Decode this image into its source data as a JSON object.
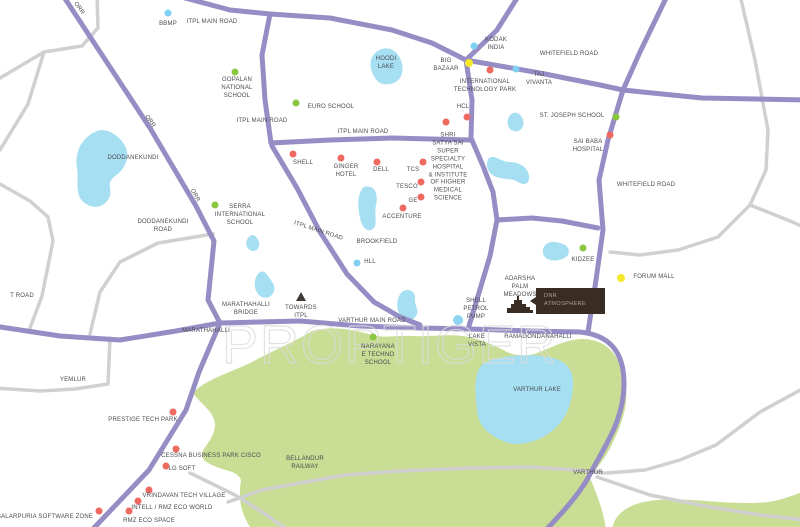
{
  "watermark": {
    "text": "PROPTIGER"
  },
  "project": {
    "name_line1": "DNR",
    "name_line2": "ATMOSPHERE"
  },
  "colors": {
    "road_major": "#968dc5",
    "road_minor": "#d0d0d0",
    "water": "#a6def2",
    "green_area": "#c9dd95",
    "project_box": "#382c23",
    "red": "#ee6a60",
    "green": "#8cc63e",
    "blue": "#7fd0f2",
    "yellow": "#f5e829",
    "lightblue": "#8ed4f0"
  },
  "map": {
    "dots": [
      {
        "name": "dot-bbmp",
        "type": "blue",
        "x": 168,
        "y": 13
      },
      {
        "name": "dot-kodak-india",
        "type": "blue",
        "x": 474,
        "y": 46
      },
      {
        "name": "dot-taj-vivanta",
        "type": "blue",
        "x": 516,
        "y": 69
      },
      {
        "name": "dot-hll",
        "type": "blue",
        "x": 357,
        "y": 263
      },
      {
        "name": "dot-big-bazaar",
        "type": "yellow",
        "x": 469,
        "y": 63
      },
      {
        "name": "dot-forum-mall",
        "type": "yellow",
        "x": 621,
        "y": 278
      },
      {
        "name": "dot-international-technology-park",
        "type": "red",
        "x": 490,
        "y": 70
      },
      {
        "name": "dot-hcl",
        "type": "red",
        "x": 467,
        "y": 117
      },
      {
        "name": "dot-satya-sai-hospital",
        "type": "red",
        "x": 446,
        "y": 122
      },
      {
        "name": "dot-sai-baba-hospital",
        "type": "red",
        "x": 610,
        "y": 135
      },
      {
        "name": "dot-shell",
        "type": "red",
        "x": 293,
        "y": 154
      },
      {
        "name": "dot-ginger-hotel",
        "type": "red",
        "x": 341,
        "y": 158
      },
      {
        "name": "dot-dell",
        "type": "red",
        "x": 377,
        "y": 162
      },
      {
        "name": "dot-tcs",
        "type": "red",
        "x": 423,
        "y": 162
      },
      {
        "name": "dot-tesco",
        "type": "red",
        "x": 421,
        "y": 182
      },
      {
        "name": "dot-ge",
        "type": "red",
        "x": 421,
        "y": 197
      },
      {
        "name": "dot-accenture",
        "type": "red",
        "x": 403,
        "y": 208
      },
      {
        "name": "dot-prestige-tech-park",
        "type": "red",
        "x": 173,
        "y": 412
      },
      {
        "name": "dot-cessna-business-park",
        "type": "red",
        "x": 176,
        "y": 449
      },
      {
        "name": "dot-lg-soft",
        "type": "red",
        "x": 166,
        "y": 466
      },
      {
        "name": "dot-vrindavan-tech-village",
        "type": "red",
        "x": 149,
        "y": 490
      },
      {
        "name": "dot-intell-rmz-eco-world",
        "type": "red",
        "x": 138,
        "y": 501
      },
      {
        "name": "dot-rmz-eco-space",
        "type": "red",
        "x": 129,
        "y": 511
      },
      {
        "name": "dot-salarpuria-software-zone",
        "type": "red",
        "x": 99,
        "y": 511
      },
      {
        "name": "dot-gopalan-national-school",
        "type": "green",
        "x": 235,
        "y": 72
      },
      {
        "name": "dot-euro-school",
        "type": "green",
        "x": 296,
        "y": 103
      },
      {
        "name": "dot-serra-international-school",
        "type": "green",
        "x": 215,
        "y": 205
      },
      {
        "name": "dot-st-joseph-school",
        "type": "green",
        "x": 616,
        "y": 117
      },
      {
        "name": "dot-kidzee",
        "type": "green",
        "x": 583,
        "y": 248
      },
      {
        "name": "dot-narayana-school",
        "type": "green",
        "x": 373,
        "y": 337
      },
      {
        "name": "dot-shell-petrol-pump",
        "type": "lightblue",
        "x": 458,
        "y": 320
      }
    ],
    "markers": [
      {
        "name": "label-bbmp",
        "lines": [
          "BBMP"
        ],
        "x": 168,
        "y": 25
      },
      {
        "name": "road-label-itpl-main-road-1",
        "lines": [
          "ITPL MAIN ROAD"
        ],
        "x": 212,
        "y": 23
      },
      {
        "name": "road-label-orr-1",
        "lines": [
          "ORR"
        ],
        "x": 78,
        "y": 9,
        "rotate": 55
      },
      {
        "name": "label-gopalan-national-school",
        "lines": [
          "GOPALAN",
          "NATIONAL",
          "SCHOOL"
        ],
        "x": 237,
        "y": 89
      },
      {
        "name": "label-euro-school",
        "lines": [
          "EURO SCHOOL"
        ],
        "x": 331,
        "y": 108
      },
      {
        "name": "label-hoodi-lake",
        "lines": [
          "HOODI",
          "LAKE"
        ],
        "x": 386,
        "y": 64
      },
      {
        "name": "label-big-bazaar",
        "lines": [
          "BIG",
          "BAZAAR"
        ],
        "x": 446,
        "y": 66
      },
      {
        "name": "label-kodak-india",
        "lines": [
          "KODAK",
          "INDIA"
        ],
        "x": 496,
        "y": 45
      },
      {
        "name": "road-label-whitefield-road-1",
        "lines": [
          "WHITEFIELD ROAD"
        ],
        "x": 569,
        "y": 55
      },
      {
        "name": "label-taj-vivanta",
        "lines": [
          "TAJ",
          "VIVANTA"
        ],
        "x": 539,
        "y": 80
      },
      {
        "name": "label-international-technology-park",
        "lines": [
          "INTERNATIONAL",
          "TECHNOLOGY PARK"
        ],
        "x": 485,
        "y": 87
      },
      {
        "name": "label-hcl",
        "lines": [
          "HCL"
        ],
        "x": 463,
        "y": 108
      },
      {
        "name": "label-st-joseph-school",
        "lines": [
          "ST. JOSEPH SCHOOL"
        ],
        "x": 572,
        "y": 117
      },
      {
        "name": "label-sai-baba-hospital",
        "lines": [
          "SAI BABA",
          "HOSPITAL"
        ],
        "x": 588,
        "y": 147
      },
      {
        "name": "label-satya-sai-hospital",
        "lines": [
          "SHRI",
          "SATYA SAI",
          "SUPER",
          "SPECIALTY",
          "HOSPITAL",
          "& INSTITUTE",
          "OF HIGHER",
          "MEDICAL",
          "SCIENCE"
        ],
        "x": 448,
        "y": 168
      },
      {
        "name": "road-label-whitefield-road-2",
        "lines": [
          "WHITEFIELD ROAD"
        ],
        "x": 646,
        "y": 186
      },
      {
        "name": "road-label-orr-2",
        "lines": [
          "ORR"
        ],
        "x": 149,
        "y": 122,
        "rotate": 55
      },
      {
        "name": "road-label-itpl-main-road-2",
        "lines": [
          "ITPL MAIN ROAD"
        ],
        "x": 262,
        "y": 122
      },
      {
        "name": "road-label-itpl-main-road-3",
        "lines": [
          "ITPL MAIN ROAD"
        ],
        "x": 363,
        "y": 133
      },
      {
        "name": "label-shell",
        "lines": [
          "SHELL"
        ],
        "x": 303,
        "y": 164
      },
      {
        "name": "label-ginger-hotel",
        "lines": [
          "GINGER",
          "HOTEL"
        ],
        "x": 346,
        "y": 172
      },
      {
        "name": "label-dell",
        "lines": [
          "DELL"
        ],
        "x": 381,
        "y": 171
      },
      {
        "name": "label-tcs",
        "lines": [
          "TCS"
        ],
        "x": 413,
        "y": 171
      },
      {
        "name": "label-tesco",
        "lines": [
          "TESCO"
        ],
        "x": 407,
        "y": 188
      },
      {
        "name": "label-ge",
        "lines": [
          "GE"
        ],
        "x": 413,
        "y": 202
      },
      {
        "name": "label-accenture",
        "lines": [
          "ACCENTURE"
        ],
        "x": 402,
        "y": 218
      },
      {
        "name": "label-doddanekundi-lake",
        "lines": [
          "DODDANEKUNDI"
        ],
        "x": 133,
        "y": 159
      },
      {
        "name": "road-label-orr-3",
        "lines": [
          "ORR"
        ],
        "x": 194,
        "y": 196,
        "rotate": 62
      },
      {
        "name": "label-serra-international-school",
        "lines": [
          "SERRA",
          "INTERNATIONAL",
          "SCHOOL"
        ],
        "x": 240,
        "y": 216
      },
      {
        "name": "road-label-doddanekundi-road",
        "lines": [
          "DODDANEKUNDI",
          "ROAD"
        ],
        "x": 163,
        "y": 227
      },
      {
        "name": "road-label-itpl-main-road-4",
        "lines": [
          "ITPL MAIN ROAD"
        ],
        "x": 318,
        "y": 232,
        "rotate": 18
      },
      {
        "name": "label-brookfield",
        "lines": [
          "BROOKFIELD"
        ],
        "x": 377,
        "y": 243
      },
      {
        "name": "label-hll",
        "lines": [
          "HLL"
        ],
        "x": 370,
        "y": 263
      },
      {
        "name": "label-kidzee",
        "lines": [
          "KIDZEE"
        ],
        "x": 583,
        "y": 261
      },
      {
        "name": "label-forum-mall",
        "lines": [
          "FORUM MALL"
        ],
        "x": 654,
        "y": 278
      },
      {
        "name": "road-label-t-road",
        "lines": [
          "T ROAD"
        ],
        "x": 22,
        "y": 297
      },
      {
        "name": "label-marathahalli-bridge",
        "lines": [
          "MARATHAHALLI",
          "BRIDGE"
        ],
        "x": 246,
        "y": 310
      },
      {
        "name": "label-towards-itpl",
        "lines": [
          "TOWARDS",
          "ITPL"
        ],
        "x": 301,
        "y": 313
      },
      {
        "name": "label-adarsha-palm-meadows",
        "lines": [
          "ADARSHA",
          "PALM",
          "MEADOWS"
        ],
        "x": 520,
        "y": 288
      },
      {
        "name": "label-shell-petrol-pump",
        "lines": [
          "SHELL",
          "PETROL",
          "PUMP"
        ],
        "x": 476,
        "y": 310
      },
      {
        "name": "road-label-varthur-main-road",
        "lines": [
          "VARTHUR MAIN ROAD"
        ],
        "x": 372,
        "y": 322
      },
      {
        "name": "label-marathahalli",
        "lines": [
          "MARATHAHALLI"
        ],
        "x": 206,
        "y": 332
      },
      {
        "name": "label-ramagondanahalli",
        "lines": [
          "RAMAGONDANAHALLI"
        ],
        "x": 538,
        "y": 338
      },
      {
        "name": "label-lake-vista",
        "lines": [
          "LAKE",
          "VISTA"
        ],
        "x": 477,
        "y": 342
      },
      {
        "name": "label-narayana-school",
        "lines": [
          "NARAYANA",
          "E TECHNO",
          "SCHOOL"
        ],
        "x": 378,
        "y": 356
      },
      {
        "name": "label-yemlur",
        "lines": [
          "YEMLUR"
        ],
        "x": 73,
        "y": 381
      },
      {
        "name": "label-varthur-lake",
        "lines": [
          "VARTHUR LAKE"
        ],
        "x": 537,
        "y": 391
      },
      {
        "name": "label-prestige-tech-park",
        "lines": [
          "PRESTIGE TECH PARK"
        ],
        "x": 143,
        "y": 421
      },
      {
        "name": "label-cessna-business-park",
        "lines": [
          "CESSNA BUSINESS PARK CISCO"
        ],
        "x": 211,
        "y": 457
      },
      {
        "name": "label-lg-soft",
        "lines": [
          "LG SOFT"
        ],
        "x": 182,
        "y": 470
      },
      {
        "name": "label-bellandur-railway",
        "lines": [
          "BELLANDUR",
          "RAILWAY"
        ],
        "x": 305,
        "y": 464
      },
      {
        "name": "label-varthur",
        "lines": [
          "VARTHUR"
        ],
        "x": 588,
        "y": 474
      },
      {
        "name": "label-vrindavan-tech-village",
        "lines": [
          "VRINDAVAN TECH VILLAGE"
        ],
        "x": 184,
        "y": 497
      },
      {
        "name": "label-intell-rmz-eco-world",
        "lines": [
          "INTELL / RMZ ECO WORLD"
        ],
        "x": 172,
        "y": 509
      },
      {
        "name": "label-rmz-eco-space",
        "lines": [
          "RMZ ECO SPACE"
        ],
        "x": 149,
        "y": 522
      },
      {
        "name": "label-salarpuria-software-zone",
        "lines": [
          "SALARPURIA SOFTWARE ZONE"
        ],
        "x": 45,
        "y": 518
      }
    ]
  }
}
